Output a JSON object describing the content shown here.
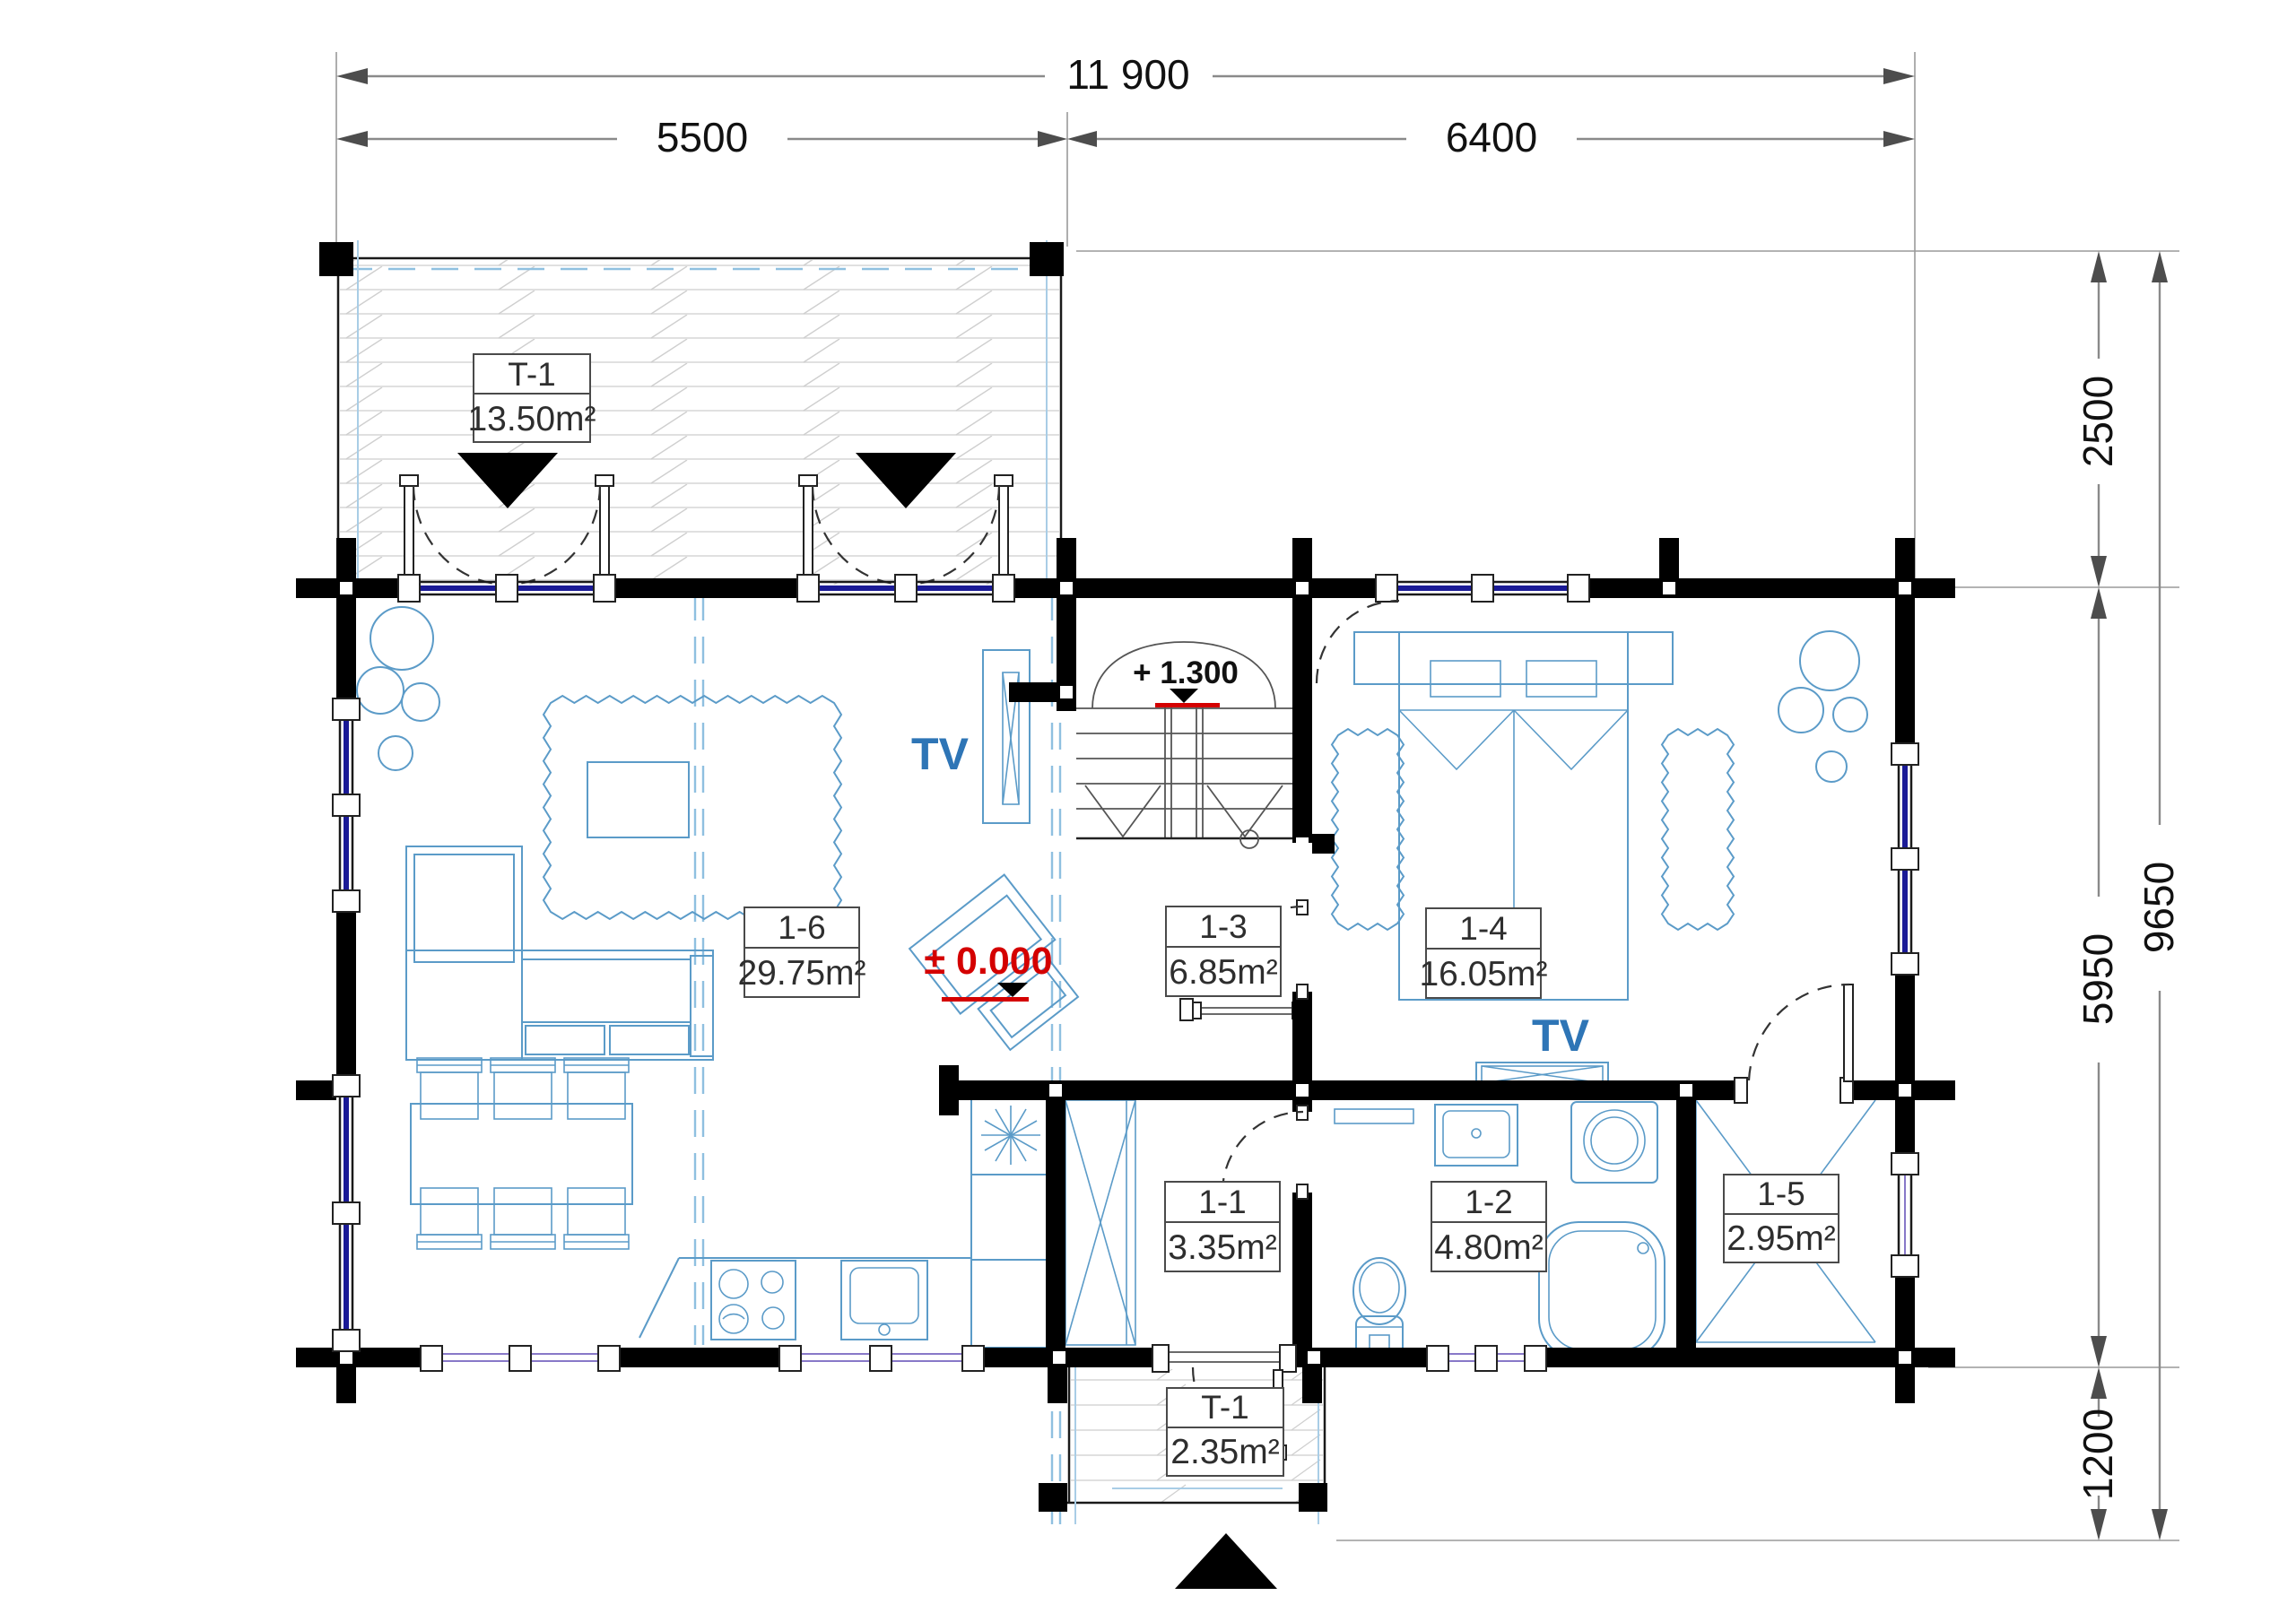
{
  "drawing": {
    "title": "ground-floor-plan",
    "dims": {
      "top_total": "11 900",
      "top_left": "5500",
      "top_right": "6400",
      "right_top": "2500",
      "right_middle": "5950",
      "right_bottom": "1200",
      "right_total": "9650"
    },
    "levels": {
      "stair": "+ 1.300",
      "ground": "± 0.000"
    },
    "tv_label": "TV",
    "rooms": [
      {
        "key": "terrace",
        "id": "T-1",
        "area": "13.50m²"
      },
      {
        "key": "living",
        "id": "1-6",
        "area": "29.75m²"
      },
      {
        "key": "hall",
        "id": "1-3",
        "area": "6.85m²"
      },
      {
        "key": "bedroom",
        "id": "1-4",
        "area": "16.05m²"
      },
      {
        "key": "hallway",
        "id": "1-1",
        "area": "3.35m²"
      },
      {
        "key": "bathroom",
        "id": "1-2",
        "area": "4.80m²"
      },
      {
        "key": "closet",
        "id": "1-5",
        "area": "2.95m²"
      },
      {
        "key": "porch",
        "id": "T-1",
        "area": "2.35m²"
      }
    ],
    "colors": {
      "wall": "#000000",
      "furniture": "#5b9bc8",
      "window_glass": "#1a1a96",
      "window_glass_alt": "#8878c8",
      "accent_red": "#d40000",
      "tv_blue": "#2e75b6",
      "dimension": "#8a8a8a",
      "deck_hatch": "#d6d6d6",
      "roof_guide": "#8fc0e0"
    }
  }
}
